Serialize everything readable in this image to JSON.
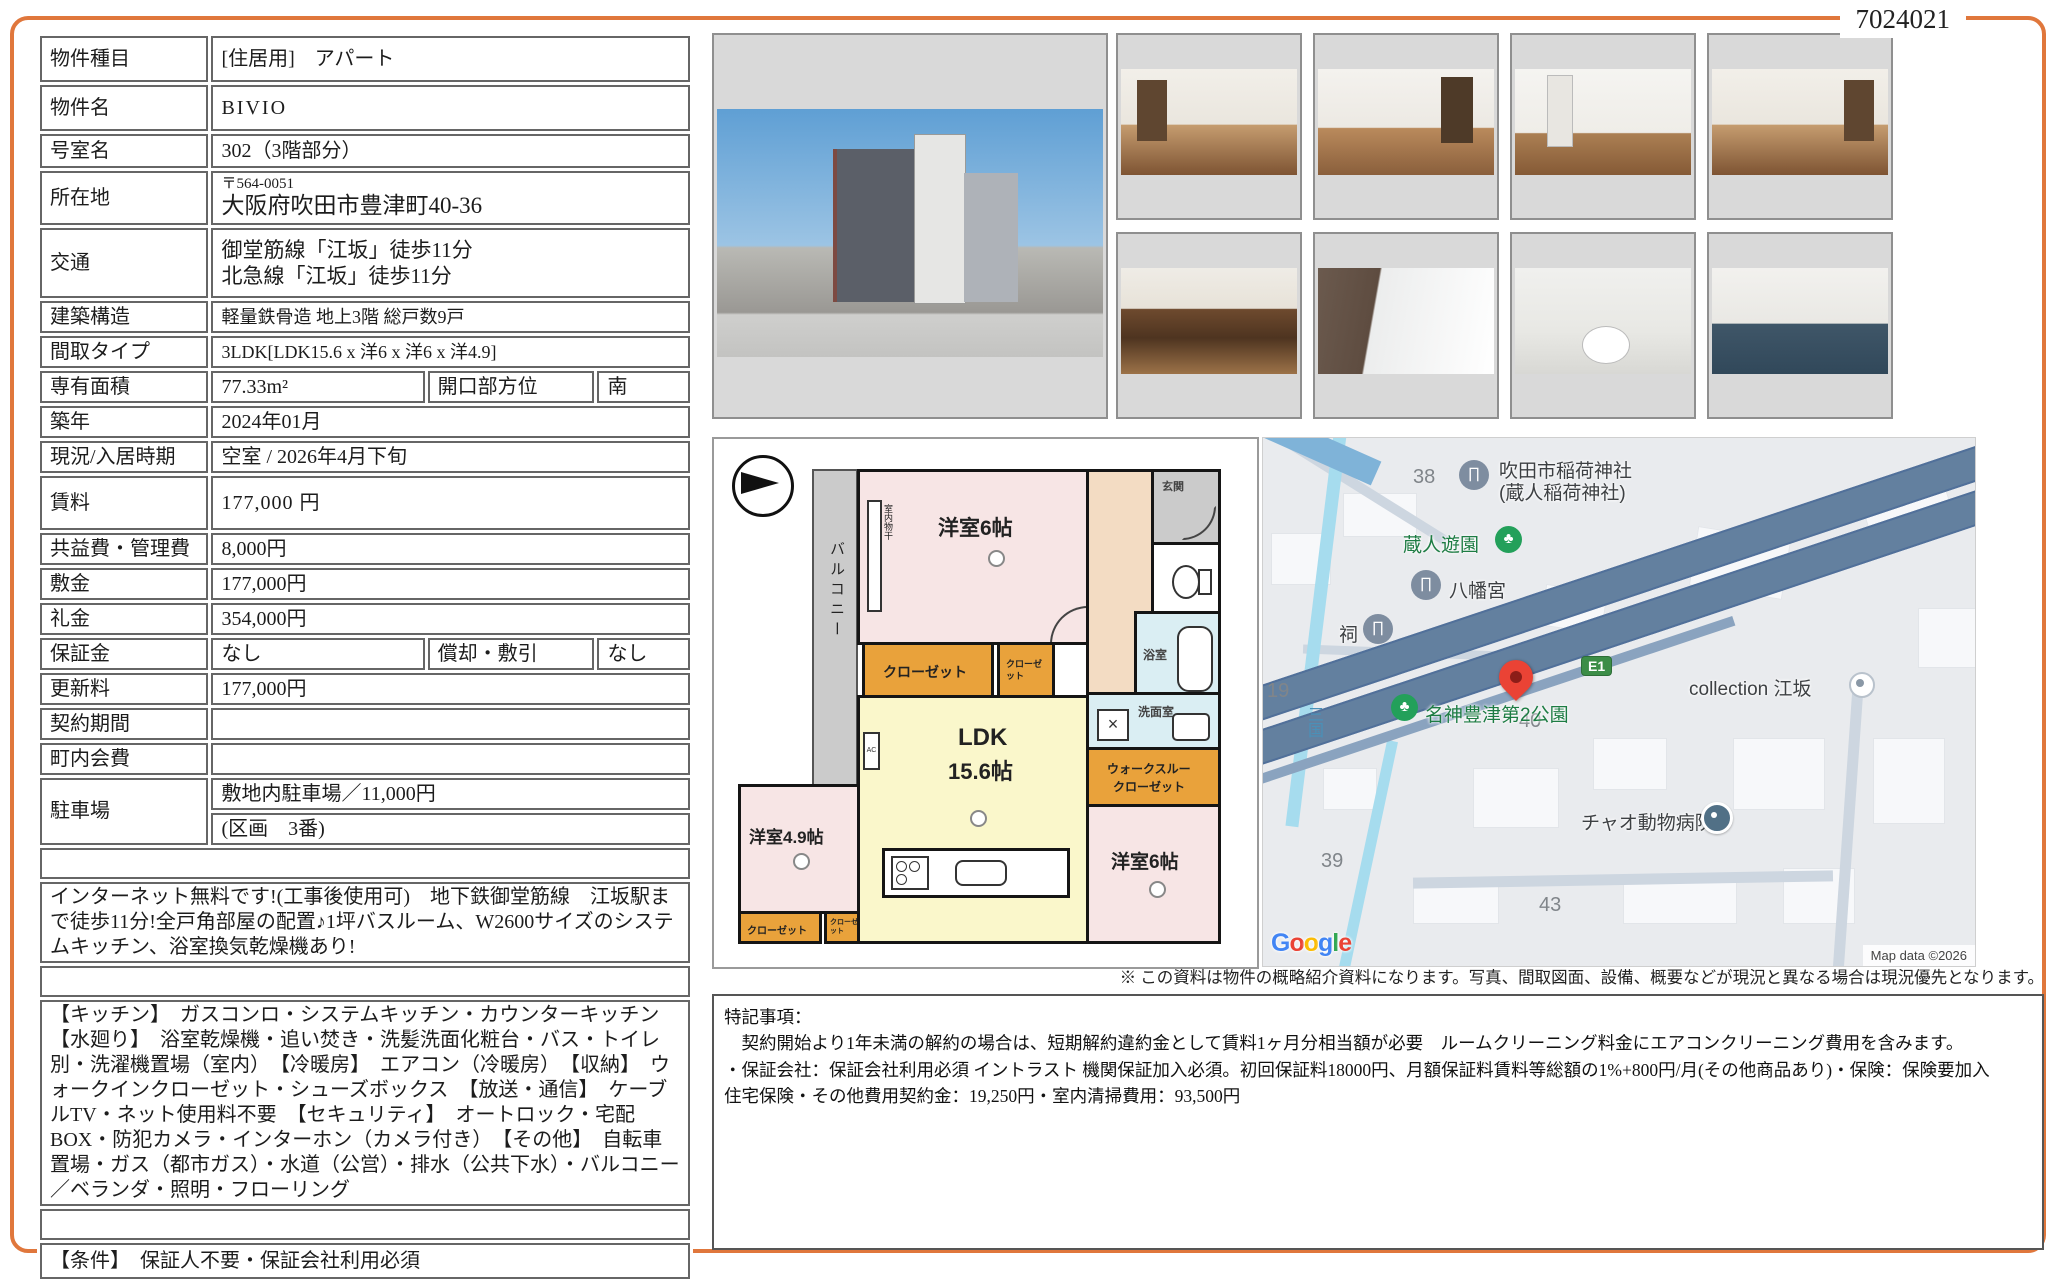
{
  "page": {
    "doc_number": "7024021",
    "accent_color": "#e0773c"
  },
  "table": {
    "rows": [
      {
        "label": "物件種目",
        "value": "[住居用]　アパート"
      },
      {
        "label": "物件名",
        "value": "BIVIO"
      },
      {
        "label": "号室名",
        "value": "302（3階部分）"
      },
      {
        "label": "所在地",
        "postal": "〒564-0051",
        "value": "大阪府吹田市豊津町40-36"
      },
      {
        "label": "交通",
        "line1": "御堂筋線「江坂」徒歩11分",
        "line2": "北急線「江坂」徒歩11分"
      },
      {
        "label": "建築構造",
        "value": "軽量鉄骨造 地上3階 総戸数9戸"
      },
      {
        "label": "間取タイプ",
        "value": "3LDK[LDK15.6 x 洋6 x 洋6 x 洋4.9]"
      },
      {
        "label": "専有面積",
        "value": "77.33m²",
        "sub_label": "開口部方位",
        "sub_value": "南"
      },
      {
        "label": "築年",
        "value": "2024年01月"
      },
      {
        "label": "現況/入居時期",
        "value": "空室 / 2026年4月下旬"
      },
      {
        "label": "賃料",
        "value": "177,000 円"
      },
      {
        "label": "共益費・管理費",
        "value": "8,000円"
      },
      {
        "label": "敷金",
        "value": "177,000円"
      },
      {
        "label": "礼金",
        "value": "354,000円"
      },
      {
        "label": "保証金",
        "value": "なし",
        "sub_label": "償却・敷引",
        "sub_value": "なし"
      },
      {
        "label": "更新料",
        "value": "177,000円"
      },
      {
        "label": "契約期間",
        "value": ""
      },
      {
        "label": "町内会費",
        "value": ""
      },
      {
        "label": "駐車場",
        "value": "敷地内駐車場／11,000円",
        "value2": "(区画　3番)"
      }
    ],
    "sections": {
      "notes_header": "備　考",
      "notes": "インターネット無料です!(工事後使用可)　地下鉄御堂筋線　江坂駅まで徒歩11分!全戸角部屋の配置♪1坪バスルーム、W2600サイズのシステムキッチン、浴室換気乾燥機あり!",
      "equipment_header": "設　備",
      "equipment": "【キッチン】　ガスコンロ・システムキッチン・カウンターキッチン　【水廻り】　浴室乾燥機・追い焚き・洗髪洗面化粧台・バス・トイレ別・洗濯機置場（室内）　【冷暖房】　エアコン（冷暖房）　【収納】　ウォークインクローゼット・シューズボックス　【放送・通信】　ケーブルTV・ネット使用料不要　【セキュリティ】　オートロック・宅配BOX・防犯カメラ・インターホン（カメラ付き）　【その他】　自転車置場・ガス（都市ガス）・水道（公営）・排水（公共下水）・バルコニー／ベランダ・照明・フローリング",
      "conditions_header": "条　件",
      "conditions": "【条件】　保証人不要・保証会社利用必須"
    }
  },
  "photos": [
    "exterior",
    "living-room",
    "bedroom",
    "hallway-closet",
    "bedroom-balcony",
    "kitchen",
    "bathroom",
    "toilet",
    "washroom"
  ],
  "floorplan": {
    "balcony": "バルコニー",
    "laundry": "室内物干",
    "room_a": "洋室6帖",
    "entrance": "玄関",
    "bath": "浴室",
    "washroom": "洗面室",
    "closet": "クローゼット",
    "closet_small": "クローゼット",
    "ldk_line1": "LDK",
    "ldk_line2": "15.6帖",
    "wtc_line1": "ウォークスルー",
    "wtc_line2": "クローゼット",
    "room_b": "洋室4.9帖",
    "room_c": "洋室6帖",
    "ac": "AC"
  },
  "map": {
    "n38": "38",
    "n19": "19",
    "n39": "39",
    "n40": "40",
    "n43": "43",
    "shrine_line1": "吹田市稲荷神社",
    "shrine_line2": "(蔵人稲荷神社)",
    "park1": "蔵人遊園",
    "hachimangu": "八幡宮",
    "hokora": "祠",
    "e1": "E1",
    "collection": "collection 江坂",
    "park2": "名神豊津第2公園",
    "river": "三国",
    "vet": "チャオ動物病院",
    "google_letters": [
      "G",
      "o",
      "o",
      "g",
      "l",
      "e"
    ],
    "map_data": "Map data ©2026"
  },
  "footer": {
    "disclaimer": "※ この資料は物件の概略紹介資料になります。写真、間取図面、設備、概要などが現況と異なる場合は現況優先となります。",
    "tokki_title": "特記事項：",
    "tokki_line1": "　契約開始より1年未満の解約の場合は、短期解約違約金として賃料1ヶ月分相当額が必要　ルームクリーニング料金にエアコンクリーニング費用を含みます。",
    "tokki_line2": "・保証会社：保証会社利用必須 イントラスト 機関保証加入必須。初回保証料18000円、月額保証料賃料等総額の1%+800円/月(その他商品あり)・保険：保険要加入",
    "tokki_line3": "住宅保険・その他費用契約金：19,250円・室内清掃費用：93,500円"
  }
}
